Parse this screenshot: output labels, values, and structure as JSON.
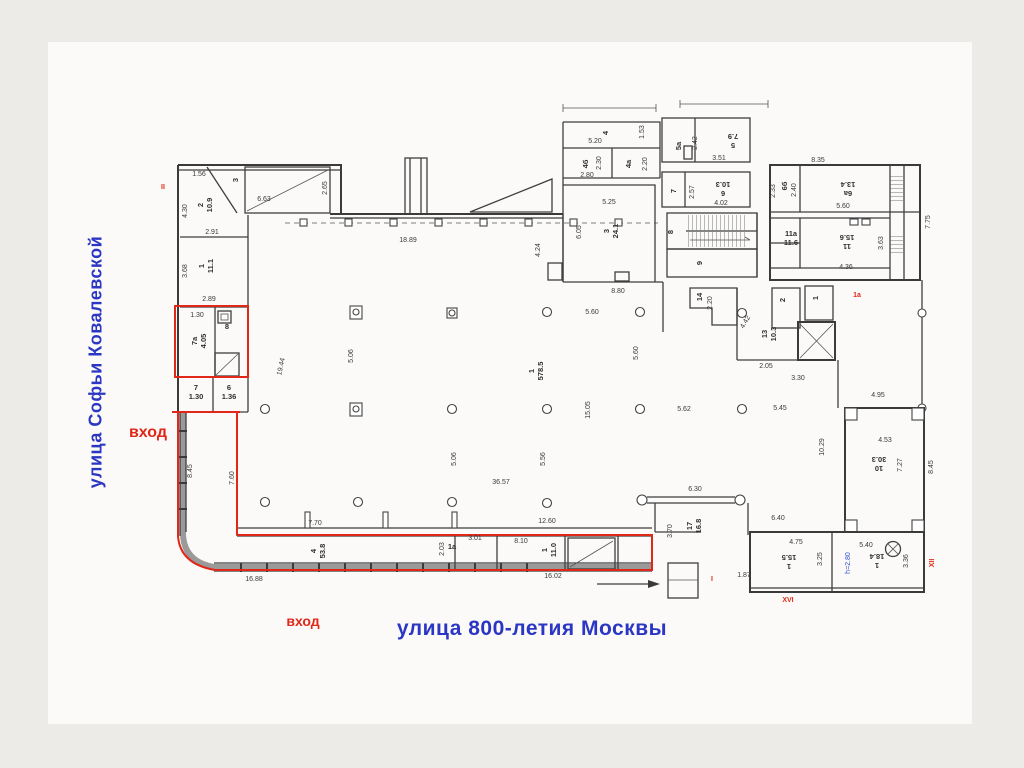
{
  "streets": {
    "left": "улица Софьи Ковалевской",
    "bottom": "улица 800-летия Москвы"
  },
  "entrances": {
    "left": "вход",
    "bottom": "вход"
  },
  "colors": {
    "street_blue": "#2b36c3",
    "entrance_red": "#e02718",
    "outline_red": "#e02718",
    "wall_gray": "#3f3f3f",
    "note_blue": "#2a50d0"
  },
  "plan": {
    "rooms": [
      {
        "n": "2",
        "a": "10.9",
        "x": 205,
        "y": 205,
        "r": -90
      },
      {
        "n": "1",
        "a": "11.1",
        "x": 206,
        "y": 266,
        "r": -90
      },
      {
        "n": "3",
        "a": "",
        "x": 238,
        "y": 180,
        "r": -90
      },
      {
        "n": "7a",
        "a": "4.05",
        "x": 199,
        "y": 341,
        "r": -90
      },
      {
        "n": "8",
        "a": "",
        "x": 227,
        "y": 329,
        "r": 0
      },
      {
        "n": "7",
        "a": "1.30",
        "x": 196,
        "y": 392,
        "r": 0
      },
      {
        "n": "6",
        "a": "1.36",
        "x": 229,
        "y": 392,
        "r": 0
      },
      {
        "n": "4",
        "a": "53.8",
        "x": 318,
        "y": 551,
        "r": -90
      },
      {
        "n": "1a",
        "a": "",
        "x": 452,
        "y": 549,
        "r": 0
      },
      {
        "n": "1",
        "a": "11.0",
        "x": 549,
        "y": 550,
        "r": -90
      },
      {
        "n": "1",
        "a": "578.5",
        "x": 536,
        "y": 371,
        "r": -90
      },
      {
        "n": "17",
        "a": "16.8",
        "x": 694,
        "y": 526,
        "r": -90
      },
      {
        "n": "14",
        "a": "",
        "x": 702,
        "y": 297,
        "r": -90
      },
      {
        "n": "13",
        "a": "10.3",
        "x": 769,
        "y": 334,
        "r": -90
      },
      {
        "n": "10",
        "a": "30.3",
        "x": 879,
        "y": 464,
        "r": 180
      },
      {
        "n": "4",
        "a": "",
        "x": 608,
        "y": 133,
        "r": -90
      },
      {
        "n": "4б",
        "a": "",
        "x": 588,
        "y": 164,
        "r": -90
      },
      {
        "n": "4a",
        "a": "",
        "x": 631,
        "y": 164,
        "r": -90
      },
      {
        "n": "3",
        "a": "24.1",
        "x": 611,
        "y": 231,
        "r": -90
      },
      {
        "n": "5a",
        "a": "",
        "x": 681,
        "y": 146,
        "r": -90
      },
      {
        "n": "5",
        "a": "7.9",
        "x": 733,
        "y": 141,
        "r": 180
      },
      {
        "n": "7",
        "a": "",
        "x": 676,
        "y": 191,
        "r": -90
      },
      {
        "n": "6",
        "a": "10.3",
        "x": 723,
        "y": 189,
        "r": 180
      },
      {
        "n": "8",
        "a": "",
        "x": 673,
        "y": 232,
        "r": -90
      },
      {
        "n": "9",
        "a": "",
        "x": 702,
        "y": 263,
        "r": -90
      },
      {
        "n": "6б",
        "a": "",
        "x": 787,
        "y": 186,
        "r": -90
      },
      {
        "n": "6a",
        "a": "13.4",
        "x": 848,
        "y": 189,
        "r": 180
      },
      {
        "n": "11a",
        "a": "11.6",
        "x": 791,
        "y": 238,
        "r": 0
      },
      {
        "n": "11",
        "a": "15.6",
        "x": 847,
        "y": 242,
        "r": 180
      },
      {
        "n": "2",
        "a": "",
        "x": 785,
        "y": 300,
        "r": -90
      },
      {
        "n": "1",
        "a": "",
        "x": 818,
        "y": 298,
        "r": -90
      },
      {
        "n": "1",
        "a": "15.5",
        "x": 789,
        "y": 562,
        "r": 180
      },
      {
        "n": "1",
        "a": "18.4",
        "x": 877,
        "y": 561,
        "r": 180
      }
    ],
    "dims": [
      {
        "t": "1.56",
        "x": 199,
        "y": 176
      },
      {
        "t": "6.63",
        "x": 264,
        "y": 201
      },
      {
        "t": "2.65",
        "x": 327,
        "y": 188,
        "r": -90
      },
      {
        "t": "4.30",
        "x": 187,
        "y": 211,
        "r": -90
      },
      {
        "t": "2.91",
        "x": 212,
        "y": 234
      },
      {
        "t": "3.68",
        "x": 187,
        "y": 271,
        "r": -90
      },
      {
        "t": "2.89",
        "x": 209,
        "y": 301
      },
      {
        "t": "1.30",
        "x": 197,
        "y": 317
      },
      {
        "t": "8.45",
        "x": 192,
        "y": 471,
        "r": -90
      },
      {
        "t": "7.60",
        "x": 234,
        "y": 478,
        "r": -90
      },
      {
        "t": "16.88",
        "x": 254,
        "y": 581
      },
      {
        "t": "16.02",
        "x": 553,
        "y": 578
      },
      {
        "t": "7.70",
        "x": 315,
        "y": 525
      },
      {
        "t": "2.03",
        "x": 444,
        "y": 549,
        "r": -90
      },
      {
        "t": "3.01",
        "x": 475,
        "y": 540
      },
      {
        "t": "8.10",
        "x": 521,
        "y": 543
      },
      {
        "t": "12.60",
        "x": 547,
        "y": 523
      },
      {
        "t": "36.57",
        "x": 501,
        "y": 484
      },
      {
        "t": "5.06",
        "x": 353,
        "y": 356,
        "r": -90
      },
      {
        "t": "19.44",
        "x": 283,
        "y": 367,
        "r": -78
      },
      {
        "t": "5.60",
        "x": 592,
        "y": 314
      },
      {
        "t": "5.60",
        "x": 638,
        "y": 353,
        "r": -90
      },
      {
        "t": "5.06",
        "x": 456,
        "y": 459,
        "r": -90
      },
      {
        "t": "5.56",
        "x": 545,
        "y": 459,
        "r": -90
      },
      {
        "t": "15.05",
        "x": 590,
        "y": 410,
        "r": -90
      },
      {
        "t": "5.62",
        "x": 684,
        "y": 411
      },
      {
        "t": "5.45",
        "x": 780,
        "y": 410
      },
      {
        "t": "10.29",
        "x": 824,
        "y": 447,
        "r": -90
      },
      {
        "t": "18.89",
        "x": 408,
        "y": 242
      },
      {
        "t": "4.24",
        "x": 540,
        "y": 250,
        "r": -90
      },
      {
        "t": "8.80",
        "x": 618,
        "y": 293
      },
      {
        "t": "6.30",
        "x": 695,
        "y": 491
      },
      {
        "t": "3.70",
        "x": 672,
        "y": 531,
        "r": -90
      },
      {
        "t": "6.40",
        "x": 778,
        "y": 520
      },
      {
        "t": "2.05",
        "x": 766,
        "y": 368
      },
      {
        "t": "3.30",
        "x": 798,
        "y": 380
      },
      {
        "t": "4.42",
        "x": 747,
        "y": 323,
        "r": -60
      },
      {
        "t": "2.20",
        "x": 712,
        "y": 303,
        "r": -90
      },
      {
        "t": "4.95",
        "x": 878,
        "y": 397
      },
      {
        "t": "4.53",
        "x": 885,
        "y": 442
      },
      {
        "t": "7.27",
        "x": 902,
        "y": 465,
        "r": -90
      },
      {
        "t": "8.45",
        "x": 933,
        "y": 467,
        "r": -90
      },
      {
        "t": "4.75",
        "x": 796,
        "y": 544
      },
      {
        "t": "3.25",
        "x": 822,
        "y": 559,
        "r": -90
      },
      {
        "t": "5.40",
        "x": 866,
        "y": 547
      },
      {
        "t": "3.36",
        "x": 908,
        "y": 561,
        "r": -90
      },
      {
        "t": "1.87",
        "x": 744,
        "y": 577
      },
      {
        "t": "5.20",
        "x": 595,
        "y": 143
      },
      {
        "t": "1.53",
        "x": 644,
        "y": 132,
        "r": -90
      },
      {
        "t": "2.30",
        "x": 601,
        "y": 163,
        "r": -90
      },
      {
        "t": "2.80",
        "x": 587,
        "y": 177
      },
      {
        "t": "2.20",
        "x": 647,
        "y": 164,
        "r": -90
      },
      {
        "t": "5.25",
        "x": 609,
        "y": 204
      },
      {
        "t": "6.05",
        "x": 581,
        "y": 232,
        "r": -90
      },
      {
        "t": "2.42",
        "x": 697,
        "y": 143,
        "r": -90
      },
      {
        "t": "3.51",
        "x": 719,
        "y": 160
      },
      {
        "t": "2.57",
        "x": 694,
        "y": 192,
        "r": -90
      },
      {
        "t": "4.02",
        "x": 721,
        "y": 205
      },
      {
        "t": "8.35",
        "x": 818,
        "y": 162
      },
      {
        "t": "2.40",
        "x": 796,
        "y": 190,
        "r": -90
      },
      {
        "t": "5.60",
        "x": 843,
        "y": 208
      },
      {
        "t": "2.33",
        "x": 775,
        "y": 191,
        "r": -90
      },
      {
        "t": "4.36",
        "x": 846,
        "y": 269
      },
      {
        "t": "3.63",
        "x": 883,
        "y": 243,
        "r": -90
      },
      {
        "t": "7.75",
        "x": 930,
        "y": 222,
        "r": -90
      }
    ],
    "notes": [
      {
        "t": "h=2.80",
        "x": 850,
        "y": 563,
        "r": -90,
        "c": "blue"
      }
    ],
    "marks": [
      {
        "t": "II",
        "x": 163,
        "y": 189
      },
      {
        "t": "1a",
        "x": 857,
        "y": 297
      },
      {
        "t": "I",
        "x": 712,
        "y": 581
      },
      {
        "t": "XII",
        "x": 934,
        "y": 563,
        "r": -90
      },
      {
        "t": "XVI",
        "x": 788,
        "y": 602
      }
    ]
  }
}
